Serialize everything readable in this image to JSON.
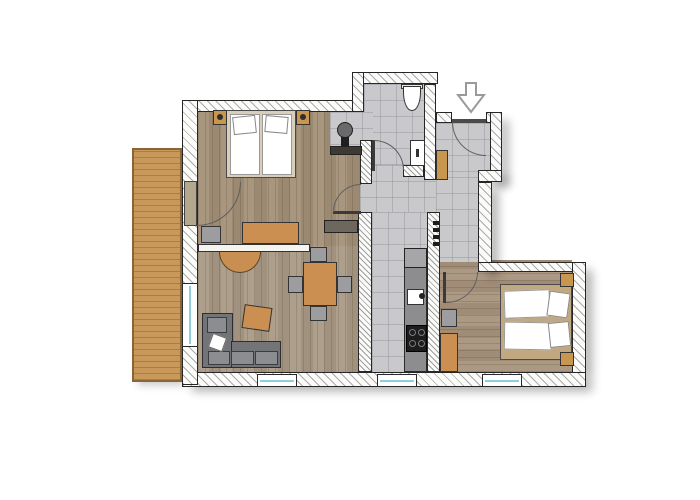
{
  "figure": {
    "type": "apartment-floor-plan",
    "background": "#ffffff",
    "palette": {
      "wall_outline": "#262626",
      "wall_hatch": "#696969",
      "tile_floor": "#c9c9cc",
      "wood_bedroom1": "#a39078",
      "wood_living": "#a99a85",
      "wood_bedroom2": "#a8947d",
      "terrace_wood": "#c8995a",
      "furniture_orange": "#cb8f51",
      "furniture_gray": "#9d9d9f",
      "sofa_gray": "#737478",
      "counter_gray": "#8d8d8f",
      "window_glass": "#8ecfdf",
      "appliance_dark": "#1c1c1c",
      "door_arc": "#5f5f5f"
    }
  },
  "elements": [
    {
      "n": "terrace-deck",
      "k": "terrace sht",
      "x": 132,
      "y": 148,
      "w": 50,
      "h": 234
    },
    {
      "n": "bedroom1-floor",
      "k": "wood-v",
      "x": 198,
      "y": 112,
      "w": 174,
      "h": 134,
      "f": "#a39078"
    },
    {
      "n": "living-room-floor",
      "k": "wood-v",
      "x": 198,
      "y": 246,
      "w": 174,
      "h": 126,
      "f": "#a99a85"
    },
    {
      "n": "bedroom2-floor",
      "k": "wood-h",
      "x": 436,
      "y": 260,
      "w": 136,
      "h": 112,
      "f": "#a8947d"
    },
    {
      "n": "wc-floor",
      "k": "tile",
      "x": 364,
      "y": 84,
      "w": 60,
      "h": 84
    },
    {
      "n": "basin-niche-floor",
      "k": "tile",
      "x": 330,
      "y": 112,
      "w": 43,
      "h": 40
    },
    {
      "n": "hallway-floor",
      "k": "tile",
      "x": 360,
      "y": 165,
      "w": 118,
      "h": 47
    },
    {
      "n": "entry-floor",
      "k": "tile",
      "x": 436,
      "y": 123,
      "w": 54,
      "h": 54
    },
    {
      "n": "entry-hall-floor",
      "k": "tile",
      "x": 436,
      "y": 177,
      "w": 42,
      "h": 85
    },
    {
      "n": "kitchen-corridor-floor",
      "k": "tile",
      "x": 372,
      "y": 212,
      "w": 55,
      "h": 160
    },
    {
      "n": "wall-top-bedroom1",
      "k": "wall",
      "x": 182,
      "y": 100,
      "w": 182,
      "h": 12
    },
    {
      "n": "wall-wc-top",
      "k": "wall",
      "x": 352,
      "y": 72,
      "w": 86,
      "h": 12
    },
    {
      "n": "wall-wc-west-step",
      "k": "wall",
      "x": 352,
      "y": 72,
      "w": 12,
      "h": 40
    },
    {
      "n": "wall-wc-east",
      "k": "wall",
      "x": 424,
      "y": 84,
      "w": 12,
      "h": 96
    },
    {
      "n": "wall-entry-north-left",
      "k": "wall",
      "x": 436,
      "y": 112,
      "w": 16,
      "h": 11
    },
    {
      "n": "wall-entry-north-right",
      "k": "wall",
      "x": 486,
      "y": 112,
      "w": 16,
      "h": 11
    },
    {
      "n": "wall-east-upper",
      "k": "wall sh",
      "x": 490,
      "y": 112,
      "w": 12,
      "h": 70
    },
    {
      "n": "wall-east-step",
      "k": "wall sh",
      "x": 478,
      "y": 170,
      "w": 24,
      "h": 12
    },
    {
      "n": "wall-east-mid",
      "k": "wall sh",
      "x": 478,
      "y": 182,
      "w": 14,
      "h": 90
    },
    {
      "n": "wall-bedroom2-north",
      "k": "wall",
      "x": 478,
      "y": 262,
      "w": 108,
      "h": 10
    },
    {
      "n": "wall-bedroom2-east",
      "k": "wall sh",
      "x": 572,
      "y": 262,
      "w": 14,
      "h": 112
    },
    {
      "n": "wall-bottom",
      "k": "wall sh",
      "x": 182,
      "y": 372,
      "w": 404,
      "h": 15
    },
    {
      "n": "wall-corridor-east",
      "k": "wall dense",
      "x": 427,
      "y": 212,
      "w": 13,
      "h": 160
    },
    {
      "n": "wall-living-east",
      "k": "wall dense",
      "x": 358,
      "y": 212,
      "w": 14,
      "h": 160
    },
    {
      "n": "wall-niche-stub",
      "k": "wall dense",
      "x": 360,
      "y": 140,
      "w": 12,
      "h": 44
    },
    {
      "n": "wall-west",
      "k": "wall",
      "x": 182,
      "y": 100,
      "w": 16,
      "h": 285
    },
    {
      "n": "wall-wc-south",
      "k": "wall dense",
      "x": 403,
      "y": 165,
      "w": 21,
      "h": 12
    },
    {
      "n": "partition-bedroom1-living",
      "k": "thin",
      "x": 198,
      "y": 244,
      "w": 112,
      "h": 8
    },
    {
      "n": "washbasin-counter",
      "k": "rect",
      "x": 330,
      "y": 146,
      "w": 32,
      "h": 9,
      "f": "#3e3a33",
      "bc": "#222222"
    },
    {
      "n": "washbasin-bowl-icon",
      "k": "rect circ",
      "x": 337,
      "y": 122,
      "w": 16,
      "h": 16,
      "f": "#6a6a6d",
      "bc": "#1f1f1f"
    },
    {
      "n": "washbasin-pedestal",
      "k": "noborder",
      "x": 341,
      "y": 137,
      "w": 8,
      "h": 9,
      "f": "#1f1f1f"
    },
    {
      "n": "toilet-tank",
      "k": "rect",
      "x": 401,
      "y": 84,
      "w": 22,
      "h": 5,
      "f": "#e8e8e6"
    },
    {
      "n": "toilet-icon",
      "k": "toilet",
      "x": 403,
      "y": 86,
      "w": 18,
      "h": 25
    },
    {
      "n": "wc-sink",
      "k": "rect",
      "x": 410,
      "y": 140,
      "w": 15,
      "h": 26,
      "f": "#ffffff"
    },
    {
      "n": "wc-sink-tap",
      "k": "noborder",
      "x": 416,
      "y": 149,
      "w": 3,
      "h": 8,
      "f": "#333333"
    },
    {
      "n": "bed1-frame",
      "k": "rect",
      "x": 226,
      "y": 110,
      "w": 70,
      "h": 68,
      "f": "#d9cdbb",
      "bc": "#4a4a4a"
    },
    {
      "n": "bed1-mattress-left",
      "k": "rect",
      "x": 230,
      "y": 114,
      "w": 30,
      "h": 61,
      "f": "#ffffff",
      "bc": "#999999"
    },
    {
      "n": "bed1-mattress-right",
      "k": "rect",
      "x": 262,
      "y": 114,
      "w": 30,
      "h": 61,
      "f": "#ffffff",
      "bc": "#999999"
    },
    {
      "n": "bed1-pillow-left",
      "k": "rect",
      "x": 233,
      "y": 116,
      "w": 23,
      "h": 18,
      "f": "#ffffff",
      "bc": "#888888",
      "r": -6
    },
    {
      "n": "bed1-pillow-right",
      "k": "rect",
      "x": 265,
      "y": 116,
      "w": 23,
      "h": 17,
      "f": "#ffffff",
      "bc": "#888888",
      "r": 5
    },
    {
      "n": "nightstand1-left",
      "k": "rect",
      "x": 213,
      "y": 110,
      "w": 14,
      "h": 15,
      "f": "#c8964f"
    },
    {
      "n": "nightstand1-left-lamp",
      "k": "noborder circ",
      "x": 217,
      "y": 114,
      "w": 6,
      "h": 6,
      "f": "#2e2e2e"
    },
    {
      "n": "nightstand1-right",
      "k": "rect",
      "x": 296,
      "y": 110,
      "w": 14,
      "h": 15,
      "f": "#c8964f"
    },
    {
      "n": "nightstand1-right-lamp",
      "k": "noborder circ",
      "x": 300,
      "y": 114,
      "w": 6,
      "h": 6,
      "f": "#2e2e2e"
    },
    {
      "n": "desk",
      "k": "rect",
      "x": 242,
      "y": 222,
      "w": 57,
      "h": 22,
      "f": "#cb8f51"
    },
    {
      "n": "desk-chair",
      "k": "rect",
      "x": 201,
      "y": 226,
      "w": 20,
      "h": 17,
      "f": "#9d9d9f"
    },
    {
      "n": "sideboard",
      "k": "rect",
      "x": 324,
      "y": 220,
      "w": 34,
      "h": 13,
      "f": "#6e675d",
      "bc": "#222222"
    },
    {
      "n": "half-round-table",
      "k": "halfdisc",
      "x": 219,
      "y": 252,
      "w": 42,
      "h": 21,
      "f": "#c98f52"
    },
    {
      "n": "sofa-arm",
      "k": "rect",
      "x": 202,
      "y": 313,
      "w": 31,
      "h": 55,
      "f": "#737478",
      "bc": "#2e2e2e"
    },
    {
      "n": "sofa-base",
      "k": "rect",
      "x": 231,
      "y": 341,
      "w": 50,
      "h": 27,
      "f": "#737478",
      "bc": "#2e2e2e"
    },
    {
      "n": "sofa-cushion-1",
      "k": "rect",
      "x": 208,
      "y": 351,
      "w": 22,
      "h": 14,
      "f": "#8c8d91",
      "bc": "#3c3c3c"
    },
    {
      "n": "sofa-cushion-2",
      "k": "rect",
      "x": 231,
      "y": 351,
      "w": 23,
      "h": 14,
      "f": "#8c8d91",
      "bc": "#3c3c3c"
    },
    {
      "n": "sofa-cushion-3",
      "k": "rect",
      "x": 255,
      "y": 351,
      "w": 23,
      "h": 14,
      "f": "#8c8d91",
      "bc": "#3c3c3c"
    },
    {
      "n": "sofa-cushion-arm",
      "k": "rect",
      "x": 207,
      "y": 317,
      "w": 20,
      "h": 16,
      "f": "#8c8d91",
      "bc": "#3c3c3c"
    },
    {
      "n": "sofa-pillow",
      "k": "rect",
      "x": 210,
      "y": 335,
      "w": 15,
      "h": 15,
      "f": "#ffffff",
      "bc": "#666666",
      "r": 20
    },
    {
      "n": "ottoman",
      "k": "rect",
      "x": 243,
      "y": 306,
      "w": 28,
      "h": 24,
      "f": "#cb8f51",
      "r": 8
    },
    {
      "n": "dining-table",
      "k": "rect",
      "x": 303,
      "y": 262,
      "w": 34,
      "h": 44,
      "f": "#cb8f51"
    },
    {
      "n": "dining-chair-north",
      "k": "rect",
      "x": 310,
      "y": 247,
      "w": 17,
      "h": 15,
      "f": "#9d9d9f"
    },
    {
      "n": "dining-chair-south",
      "k": "rect",
      "x": 310,
      "y": 306,
      "w": 17,
      "h": 15,
      "f": "#9d9d9f"
    },
    {
      "n": "dining-chair-west",
      "k": "rect",
      "x": 288,
      "y": 276,
      "w": 15,
      "h": 17,
      "f": "#9d9d9f"
    },
    {
      "n": "dining-chair-east",
      "k": "rect",
      "x": 337,
      "y": 276,
      "w": 15,
      "h": 17,
      "f": "#9d9d9f"
    },
    {
      "n": "kitchen-counter",
      "k": "rect",
      "x": 404,
      "y": 248,
      "w": 23,
      "h": 124,
      "f": "#8d8d8f",
      "bc": "#2b2b2b"
    },
    {
      "n": "kitchen-fridge",
      "k": "rect",
      "x": 404,
      "y": 248,
      "w": 23,
      "h": 20,
      "f": "#a6a6a8",
      "bc": "#222222"
    },
    {
      "n": "kitchen-sink",
      "k": "rect",
      "x": 407,
      "y": 289,
      "w": 17,
      "h": 16,
      "f": "#ffffff"
    },
    {
      "n": "kitchen-faucet",
      "k": "noborder circ",
      "x": 419,
      "y": 293,
      "w": 6,
      "h": 6,
      "f": "#222222"
    },
    {
      "n": "stove",
      "k": "rect",
      "x": 406,
      "y": 325,
      "w": 21,
      "h": 27,
      "f": "#1c1c1c",
      "bc": "#000000"
    },
    {
      "n": "stove-burner-1",
      "k": "ring",
      "x": 409,
      "y": 329,
      "w": 7,
      "h": 7
    },
    {
      "n": "stove-burner-2",
      "k": "ring",
      "x": 418,
      "y": 329,
      "w": 7,
      "h": 7
    },
    {
      "n": "stove-burner-3",
      "k": "ring",
      "x": 409,
      "y": 340,
      "w": 7,
      "h": 7
    },
    {
      "n": "stove-burner-4",
      "k": "ring",
      "x": 418,
      "y": 340,
      "w": 7,
      "h": 7
    },
    {
      "n": "entry-cabinet",
      "k": "rect",
      "x": 436,
      "y": 150,
      "w": 12,
      "h": 30,
      "f": "#c8964f"
    },
    {
      "n": "coat-hook-1",
      "k": "noborder",
      "x": 433,
      "y": 221,
      "w": 6,
      "h": 4,
      "f": "#1c1c1c"
    },
    {
      "n": "coat-hook-2",
      "k": "noborder",
      "x": 433,
      "y": 228,
      "w": 6,
      "h": 4,
      "f": "#1c1c1c"
    },
    {
      "n": "coat-hook-3",
      "k": "noborder",
      "x": 433,
      "y": 235,
      "w": 6,
      "h": 4,
      "f": "#1c1c1c"
    },
    {
      "n": "coat-hook-4",
      "k": "noborder",
      "x": 433,
      "y": 242,
      "w": 6,
      "h": 4,
      "f": "#1c1c1c"
    },
    {
      "n": "wardrobe-bedroom2",
      "k": "rect",
      "x": 440,
      "y": 333,
      "w": 18,
      "h": 39,
      "f": "#cb8f51"
    },
    {
      "n": "chair-bedroom2",
      "k": "rect",
      "x": 441,
      "y": 309,
      "w": 16,
      "h": 18,
      "f": "#9d9d9f"
    },
    {
      "n": "bed2-frame",
      "k": "rect",
      "x": 500,
      "y": 284,
      "w": 72,
      "h": 76,
      "f": "#c2a880",
      "bc": "#4a4a4a"
    },
    {
      "n": "bed2-mattress-upper",
      "k": "rect",
      "x": 504,
      "y": 290,
      "w": 46,
      "h": 28,
      "f": "#ffffff",
      "bc": "#999999",
      "r": -2
    },
    {
      "n": "bed2-mattress-lower",
      "k": "rect",
      "x": 504,
      "y": 322,
      "w": 48,
      "h": 28,
      "f": "#ffffff",
      "bc": "#999999",
      "r": 1
    },
    {
      "n": "bed2-pillow-upper",
      "k": "rect",
      "x": 548,
      "y": 292,
      "w": 21,
      "h": 25,
      "f": "#ffffff",
      "bc": "#888888",
      "r": 8
    },
    {
      "n": "bed2-pillow-lower",
      "k": "rect",
      "x": 549,
      "y": 322,
      "w": 21,
      "h": 25,
      "f": "#ffffff",
      "bc": "#888888",
      "r": -6
    },
    {
      "n": "nightstand2-top",
      "k": "rect",
      "x": 560,
      "y": 273,
      "w": 14,
      "h": 14,
      "f": "#c8964f"
    },
    {
      "n": "nightstand2-bottom",
      "k": "rect",
      "x": 560,
      "y": 352,
      "w": 14,
      "h": 14,
      "f": "#c8964f"
    },
    {
      "n": "window-living-west",
      "k": "window window-v",
      "x": 182,
      "y": 283,
      "w": 16,
      "h": 64
    },
    {
      "n": "window-living-south",
      "k": "window window-h",
      "x": 257,
      "y": 374,
      "w": 40,
      "h": 13
    },
    {
      "n": "window-kitchen-south",
      "k": "window window-h",
      "x": 377,
      "y": 374,
      "w": 40,
      "h": 13
    },
    {
      "n": "window-bedroom2-south",
      "k": "window window-h",
      "x": 482,
      "y": 374,
      "w": 40,
      "h": 13
    },
    {
      "n": "terrace-door-leaf",
      "k": "rect",
      "x": 184,
      "y": 181,
      "w": 13,
      "h": 45,
      "f": "#b3a78e",
      "bc": "#444444"
    },
    {
      "n": "terrace-door-swing",
      "k": "arc c-tl",
      "x": 197,
      "y": 182,
      "w": 44,
      "h": 44
    },
    {
      "n": "bedroom1-door-leaf",
      "k": "noborder",
      "x": 333,
      "y": 211,
      "w": 28,
      "h": 3,
      "f": "#3a3a3a"
    },
    {
      "n": "bedroom1-door-swing",
      "k": "arc c-br",
      "x": 333,
      "y": 184,
      "w": 28,
      "h": 28
    },
    {
      "n": "wc-door-leaf",
      "k": "noborder",
      "x": 372,
      "y": 140,
      "w": 3,
      "h": 31,
      "f": "#3a3a3a"
    },
    {
      "n": "wc-door-swing",
      "k": "arc c-bl",
      "x": 374,
      "y": 140,
      "w": 30,
      "h": 30
    },
    {
      "n": "entry-door-leaf",
      "k": "noborder",
      "x": 452,
      "y": 119,
      "w": 34,
      "h": 4,
      "f": "#4a4a4a"
    },
    {
      "n": "entry-door-swing",
      "k": "arc c-tr",
      "x": 452,
      "y": 122,
      "w": 34,
      "h": 34
    },
    {
      "n": "bedroom2-door-leaf",
      "k": "noborder",
      "x": 443,
      "y": 272,
      "w": 3,
      "h": 31,
      "f": "#3a3a3a"
    },
    {
      "n": "bedroom2-door-swing",
      "k": "arc c-tl",
      "x": 446,
      "y": 272,
      "w": 32,
      "h": 31
    },
    {
      "n": "entry-arrow-icon",
      "k": "arrow",
      "x": 456,
      "y": 82,
      "w": 30,
      "h": 32
    }
  ]
}
